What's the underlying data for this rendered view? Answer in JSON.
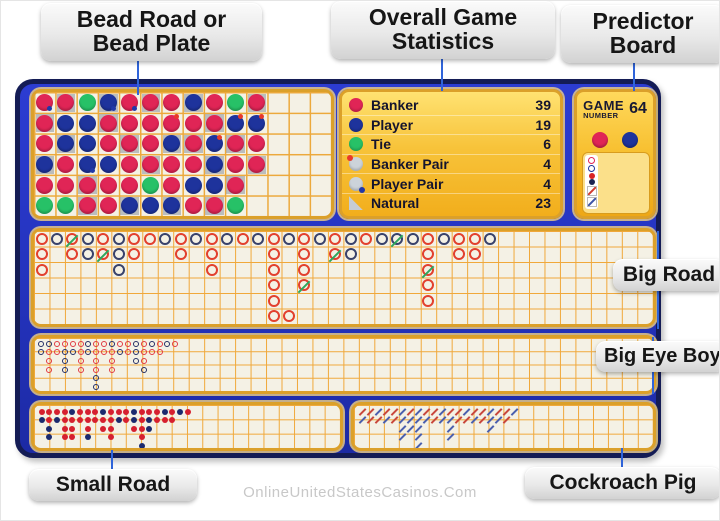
{
  "labels": {
    "bead": {
      "line1": "Bead Road or",
      "line2": "Bead Plate"
    },
    "stats": {
      "line1": "Overall Game",
      "line2": "Statistics"
    },
    "predictor": {
      "line1": "Predictor",
      "line2": "Board"
    },
    "big_road": "Big Road",
    "big_eye_boy": "Big Eye Boy",
    "small_road": "Small Road",
    "cockroach_pig": "Cockroach Pig"
  },
  "watermark": "OnlineUnitedStatesCasinos.Com",
  "stats_panel": {
    "rows": [
      {
        "icon": "banker-icon",
        "label": "Banker",
        "value": 39
      },
      {
        "icon": "player-icon",
        "label": "Player",
        "value": 19
      },
      {
        "icon": "tie-icon",
        "label": "Tie",
        "value": 6
      },
      {
        "icon": "banker-pair-icon",
        "label": "Banker Pair",
        "value": 4
      },
      {
        "icon": "player-pair-icon",
        "label": "Player Pair",
        "value": 4
      },
      {
        "icon": "natural-icon",
        "label": "Natural",
        "value": 23
      }
    ]
  },
  "predictor_board": {
    "title_line1": "GAME",
    "title_line2": "NUMBER",
    "game_number": 64,
    "outcome_circles": [
      "banker",
      "player"
    ],
    "prediction_icons": [
      "banker-outline-circle",
      "player-outline-circle",
      "banker-dot",
      "player-dot",
      "banker-slash",
      "player-slash"
    ]
  },
  "colors": {
    "banker_red": "#e02556",
    "player_blue": "#1e339c",
    "tie_green": "#27c167",
    "board_blue": "#2433bd",
    "panel_cream": "#f4f1e5",
    "gold_border": "#dba02a",
    "grid_orange": "#eca93c",
    "big_road_red": "#e2402e",
    "big_road_blue": "#39426b",
    "tie_slash_green": "#2fa75e",
    "connector_blue": "#2f64da"
  },
  "roads": {
    "bead_plate": {
      "rows": 6,
      "cols": 14,
      "legend": "tokens: r=banker b=player g=tie, n=natural shade, P=banker-pair dot, p=player-pair dot",
      "grid": [
        [
          "rp",
          "rn",
          "r",
          "bn",
          "r",
          "g"
        ],
        [
          "rn",
          "b",
          "bn",
          "r",
          "r",
          "g"
        ],
        [
          "g",
          "b",
          "b",
          "bp",
          "rn",
          "rn"
        ],
        [
          "bnp",
          "rn",
          "r",
          "b",
          "r",
          "r"
        ],
        [
          "rp",
          "r",
          "rn",
          "r",
          "r",
          "bn"
        ],
        [
          "rn",
          "r",
          "r",
          "rn",
          "g",
          "b"
        ],
        [
          "r",
          "rP",
          "bn",
          "r",
          "r",
          "bn"
        ],
        [
          "bn",
          "r",
          "rn",
          "r",
          "b",
          "r"
        ],
        [
          "r",
          "rn",
          "bP",
          "bn",
          "b",
          "rn"
        ],
        [
          "g",
          "bP",
          "rn",
          "r",
          "rn",
          "g"
        ],
        [
          "rn",
          "bP",
          "r",
          "rn"
        ],
        [],
        [],
        []
      ]
    },
    "big_road": {
      "rows": 6,
      "cols": 40,
      "legend": "per column top-to-bottom: r=banker b=player, uppercase=tie slash, .=empty cell",
      "columns": [
        "rrr",
        "b",
        "Rr",
        "bb",
        "rR",
        "bbb",
        "rr",
        "r",
        "b",
        "rr",
        "b",
        "rrr",
        "b",
        "r",
        "b",
        "rrrrrr",
        "b....r",
        "rrrR",
        "b",
        "rR",
        "bb",
        "r",
        "b",
        "B",
        "b",
        "rrRrr",
        "b",
        "rr",
        "rr",
        "b",
        "",
        "",
        "",
        "",
        "",
        "",
        "",
        "",
        "",
        ""
      ]
    },
    "big_eye_boy": {
      "columns": [
        "bb",
        "brrr",
        "rr",
        "rbbb",
        "rb",
        "rrrr",
        "bb",
        "rrrrbb",
        "rr",
        "brrr",
        "rb",
        "rr",
        "bbb",
        "rrrb",
        "br",
        "rr",
        "b",
        "r"
      ]
    },
    "small_road": {
      "columns": [
        "rb",
        "rrbb",
        "rb",
        "rrrr",
        "brrr",
        "rr",
        "rrrb",
        "rr",
        "brr",
        "rrrr",
        "rb",
        "rr",
        "bbr",
        "rrrrb",
        "rbb",
        "rr",
        "br",
        "rr",
        "b",
        "r"
      ]
    },
    "cockroach_pig": {
      "columns": [
        "rb",
        "rr",
        "br",
        "rb",
        "rr",
        "bbbb",
        "rbb",
        "bbbbbb",
        "rb",
        "rr",
        "bb",
        "rbbb",
        "rr",
        "br",
        "rb",
        "rr",
        "bbb",
        "rb",
        "rr",
        "b"
      ]
    }
  }
}
